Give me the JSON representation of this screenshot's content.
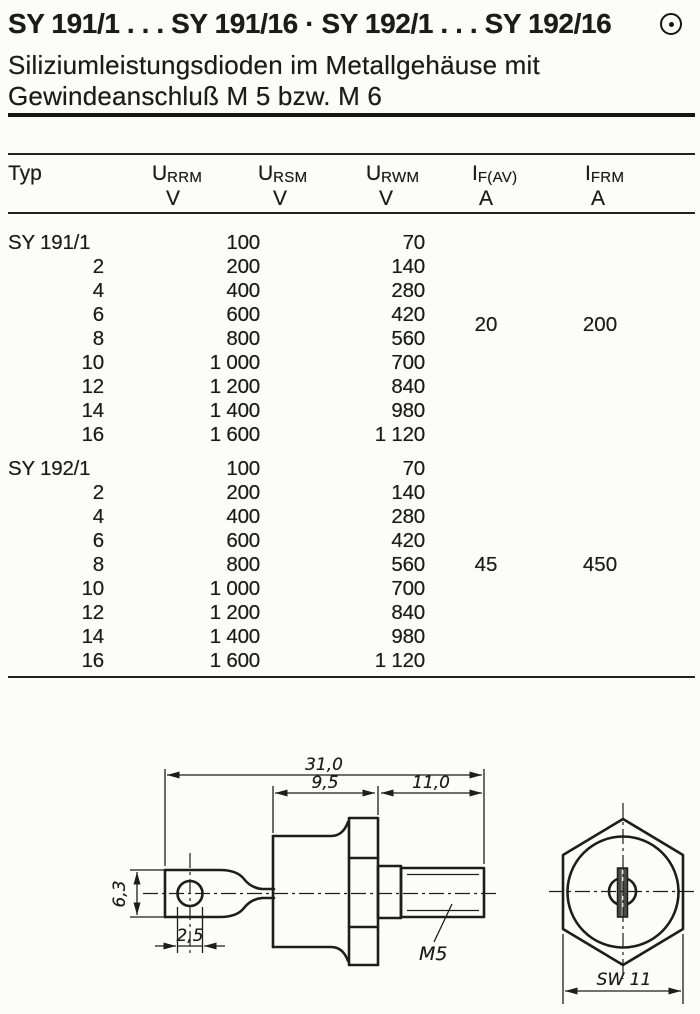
{
  "header": {
    "title": "SY 191/1 . . . SY 191/16 · SY 192/1 . . . SY 192/16",
    "symbol": "circled-dot-icon",
    "subtitle_line1": "Siliziumleistungsdioden im Metallgehäuse mit",
    "subtitle_line2": "Gewindeanschluß M 5 bzw. M 6"
  },
  "table": {
    "columns": [
      {
        "main": "Typ",
        "sub": "",
        "unit": ""
      },
      {
        "main": "U",
        "sub": "RRM",
        "unit": "V"
      },
      {
        "main": "U",
        "sub": "RSM",
        "unit": "V"
      },
      {
        "main": "U",
        "sub": "RWM",
        "unit": "V"
      },
      {
        "main": "I",
        "sub": "F(AV)",
        "unit": "A"
      },
      {
        "main": "I",
        "sub": "FRM",
        "unit": "A"
      }
    ],
    "groups": [
      {
        "rows": [
          [
            "SY 191/1",
            "100",
            "70"
          ],
          [
            "2",
            "200",
            "140"
          ],
          [
            "4",
            "400",
            "280"
          ],
          [
            "6",
            "600",
            "420"
          ],
          [
            "8",
            "800",
            "560"
          ],
          [
            "10",
            "1 000",
            "700"
          ],
          [
            "12",
            "1 200",
            "840"
          ],
          [
            "14",
            "1 400",
            "980"
          ],
          [
            "16",
            "1 600",
            "1 120"
          ]
        ],
        "if_av": "20",
        "ifrm": "200"
      },
      {
        "rows": [
          [
            "SY 192/1",
            "100",
            "70"
          ],
          [
            "2",
            "200",
            "140"
          ],
          [
            "4",
            "400",
            "280"
          ],
          [
            "6",
            "600",
            "420"
          ],
          [
            "8",
            "800",
            "560"
          ],
          [
            "10",
            "1 000",
            "700"
          ],
          [
            "12",
            "1 200",
            "840"
          ],
          [
            "14",
            "1 400",
            "980"
          ],
          [
            "16",
            "1 600",
            "1 120"
          ]
        ],
        "if_av": "45",
        "ifrm": "450"
      }
    ]
  },
  "drawing": {
    "dim_overall": "31,0",
    "dim_case": "9,5",
    "dim_stud": "11,0",
    "dim_lug_width": "6,3",
    "dim_hole": "2,5",
    "thread_label": "M5",
    "wrench_size": "SW 11"
  }
}
